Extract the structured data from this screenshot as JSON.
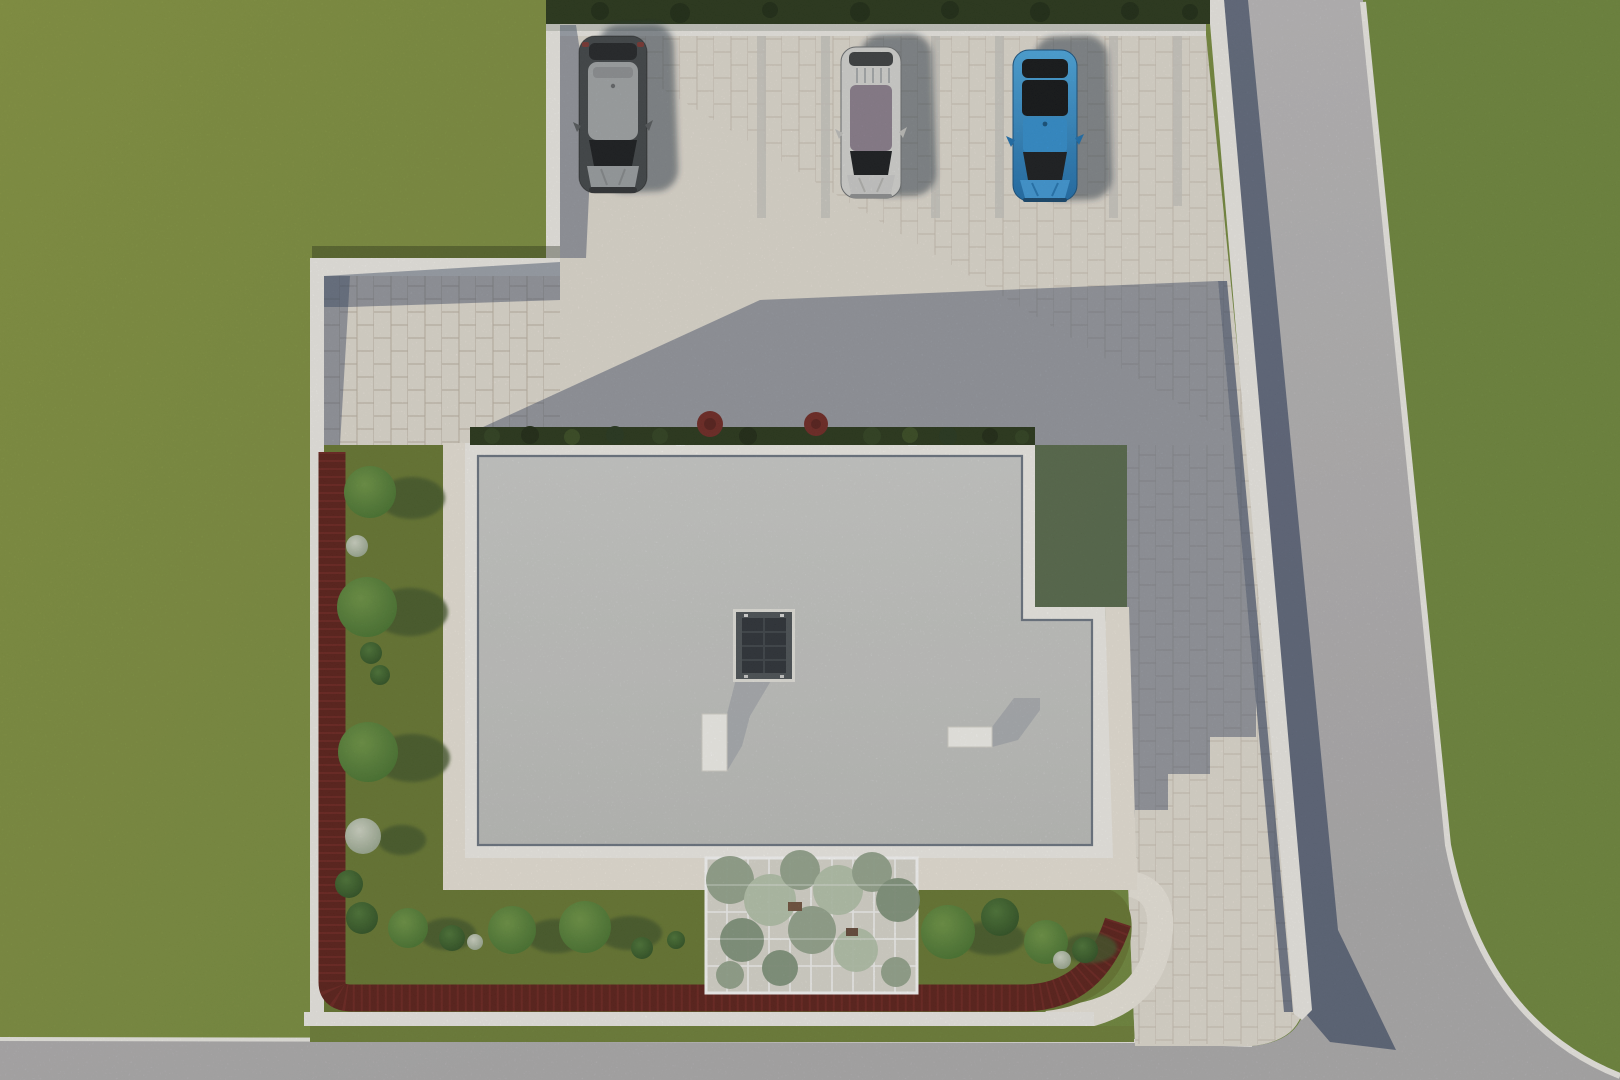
{
  "scene": {
    "kind": "aerial-architectural-render",
    "view": "top-down site plan rendering",
    "elements": [
      "lawn",
      "roads",
      "parking-lot",
      "boundary-wall",
      "flat-roof-building",
      "skylight",
      "roof-vents",
      "garden-beds",
      "maroon-hedge",
      "trees",
      "pergola",
      "cars"
    ]
  },
  "palette": {
    "grass_left": "#81923F",
    "grass_right": "#6E883A",
    "garden": "#66772F",
    "garden_verge": "#6D8036",
    "tree_shadow": "#415426",
    "road": "#B7B5B7",
    "curb": "#F1EFEA",
    "paving": "#E4DED4",
    "divider": "#CCC9C3",
    "shadow_blue": "rgba(47,63,94,0.44)",
    "wall_shadow": "rgba(40,56,88,0.62)",
    "hedge_dark": "#243317",
    "red_hedge": "#5A1B16",
    "red_hedge_speckle": "#7C2822",
    "red_bush": "#6F2420",
    "roof": "#C9CAC8",
    "roof_edge": "#6B7482",
    "parapet": "#F3F1EC",
    "walkway": "#ECE6DB",
    "skylight_frame": "#4A5055",
    "skylight_glass": "#2A2F35",
    "vent_white": "#F6F5F1",
    "vent_shadow": "#A8ACB1",
    "pergola_base": "#DCDAD1",
    "pergola_leaf_light": "#B6C4AD",
    "pergola_leaf_mid": "#93A48C",
    "pergola_leaf_dark": "#7F937B",
    "car_graphite": "#3F4347",
    "car_graphite_roof": "#A2A6A9",
    "car_silver": "#D8D8D6",
    "car_silver_glassroof": "#8B7E8E",
    "car_blue": "#2E8FD2",
    "car_glass": "#15181B",
    "car_shadow": "rgba(38,48,66,0.5)"
  },
  "site": {
    "parking": {
      "stalls": 3,
      "stall_marking": "paired paver strips"
    },
    "cars": [
      {
        "stall": 1,
        "color_name": "graphite-gray"
      },
      {
        "stall": 2,
        "color_name": "silver"
      },
      {
        "stall": 3,
        "color_name": "blue"
      }
    ],
    "building": {
      "roof_type": "flat",
      "skylights": 1,
      "roof_vents": 2,
      "footprint": "stepped rectangle"
    },
    "landscape": {
      "pergola": true,
      "maroon_hedge_border": true,
      "front_hedge_red_bushes": 2,
      "tree_count": 18
    },
    "roads": {
      "east": "vertical road",
      "south": "horizontal road",
      "junction": "rounded corner"
    }
  }
}
